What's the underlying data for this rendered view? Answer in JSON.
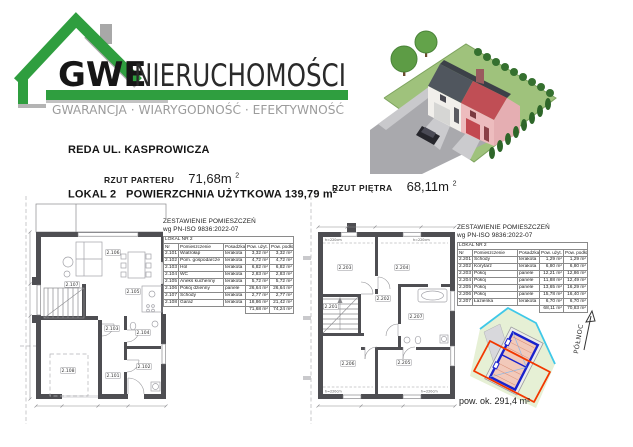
{
  "colors": {
    "brand_green": "#2f9e3f",
    "logo_gray": "#a8a8a8",
    "wall_dark": "#4e4e52",
    "site_green": "#e6f0d5",
    "site_cyan": "#3fc8e8",
    "site_red": "#f23800",
    "site_blue": "#1a22cc",
    "site_pink": "#f2c9ba",
    "roof_dark": "#50565e",
    "roof_red": "#c04e55"
  },
  "logo": {
    "brand": "GWE",
    "brand_suffix": "NIERUCHOMOŚCI",
    "tagline": "GWARANCJA · WIARYGODNOŚĆ · EFEKTYWNOŚĆ"
  },
  "listing": {
    "address": "REDA UL. KASPROWICZA",
    "unit_line": "LOKAL 2   POWIERZCHNIA UŻYTKOWA 139,79 m",
    "unit_area_sup": "2"
  },
  "ground_floor": {
    "title": "RZUT PARTERU",
    "area": "71,68m",
    "area_sup": "2",
    "table": {
      "heading1": "ZESTAWIENIE POMIESZCZEŃ",
      "heading2": "wg PN-ISO 9836:2022-07",
      "unit_label": "LOKAL NR 2",
      "columns": [
        "Nr",
        "Pomieszczenie",
        "Posadzka",
        "Pow. użyt.",
        "Pow. podłog"
      ],
      "rows": [
        [
          "2.101",
          "Wiatrołap",
          "terakota",
          "3,32 m²",
          "3,32 m²"
        ],
        [
          "2.102",
          "Pom. gospodarcze",
          "terakota",
          "4,72 m²",
          "4,72 m²"
        ],
        [
          "2.103",
          "Hol",
          "terakota",
          "6,82 m²",
          "6,82 m²"
        ],
        [
          "2.104",
          "WC",
          "terakota",
          "2,83 m²",
          "2,83 m²"
        ],
        [
          "2.105",
          "Aneks kuchenny",
          "terakota",
          "5,72 m²",
          "5,72 m²"
        ],
        [
          "2.106",
          "Pokój dzienny",
          "panele",
          "26,64 m²",
          "26,64 m²"
        ],
        [
          "2.107",
          "Schody",
          "terakota",
          "2,77 m²",
          "2,77 m²"
        ],
        [
          "2.108",
          "Garaż",
          "terakota",
          "18,86 m²",
          "21,42 m²"
        ],
        [
          "",
          "",
          "",
          "71,68 m²",
          "74,24 m²"
        ]
      ]
    },
    "plan_labels": {
      "living": "2.106",
      "stairs": "2.107",
      "kitchen": "2.105",
      "hall": "2.103",
      "wc": "2.104",
      "vestibule": "2.101",
      "utility": "2.102",
      "garage": "2.108"
    }
  },
  "upper_floor": {
    "title": "RZUT PIĘTRA",
    "area": "68,11m",
    "area_sup": "2",
    "height_note": "h=220cm",
    "table": {
      "heading1": "ZESTAWIENIE POMIESZCZEŃ",
      "heading2": "wg PN-ISO 9836:2022-07",
      "unit_label": "LOKAL NR 2",
      "columns": [
        "Nr",
        "Pomieszczenie",
        "Posadzka",
        "Pow. użyt.",
        "Pow. podłog"
      ],
      "rows": [
        [
          "2.201",
          "Schody",
          "terakota",
          "1,29 m²",
          "1,29 m²"
        ],
        [
          "2.202",
          "Korytarz",
          "terakota",
          "6,80 m²",
          "6,80 m²"
        ],
        [
          "2.203",
          "Pokój",
          "panele",
          "12,21 m²",
          "12,86 m²"
        ],
        [
          "2.204",
          "Pokój",
          "panele",
          "11,88 m²",
          "12,49 m²"
        ],
        [
          "2.205",
          "Pokój",
          "panele",
          "13,65 m²",
          "16,29 m²"
        ],
        [
          "2.206",
          "Pokój",
          "panele",
          "15,78 m²",
          "16,40 m²"
        ],
        [
          "2.207",
          "Łazienka",
          "terakota",
          "6,70 m²",
          "6,70 m²"
        ],
        [
          "",
          "",
          "",
          "68,11 m²",
          "70,83 m²"
        ]
      ]
    },
    "plan_labels": {
      "room_nw": "2.203",
      "room_ne": "2.204",
      "stairs": "2.201",
      "corridor": "2.202",
      "bathroom": "2.207",
      "room_sw": "2.206",
      "room_se": "2.205"
    }
  },
  "site_plan": {
    "area_label": "pow. ok. 291,4 m²",
    "north_label": "PÓŁNOC"
  }
}
